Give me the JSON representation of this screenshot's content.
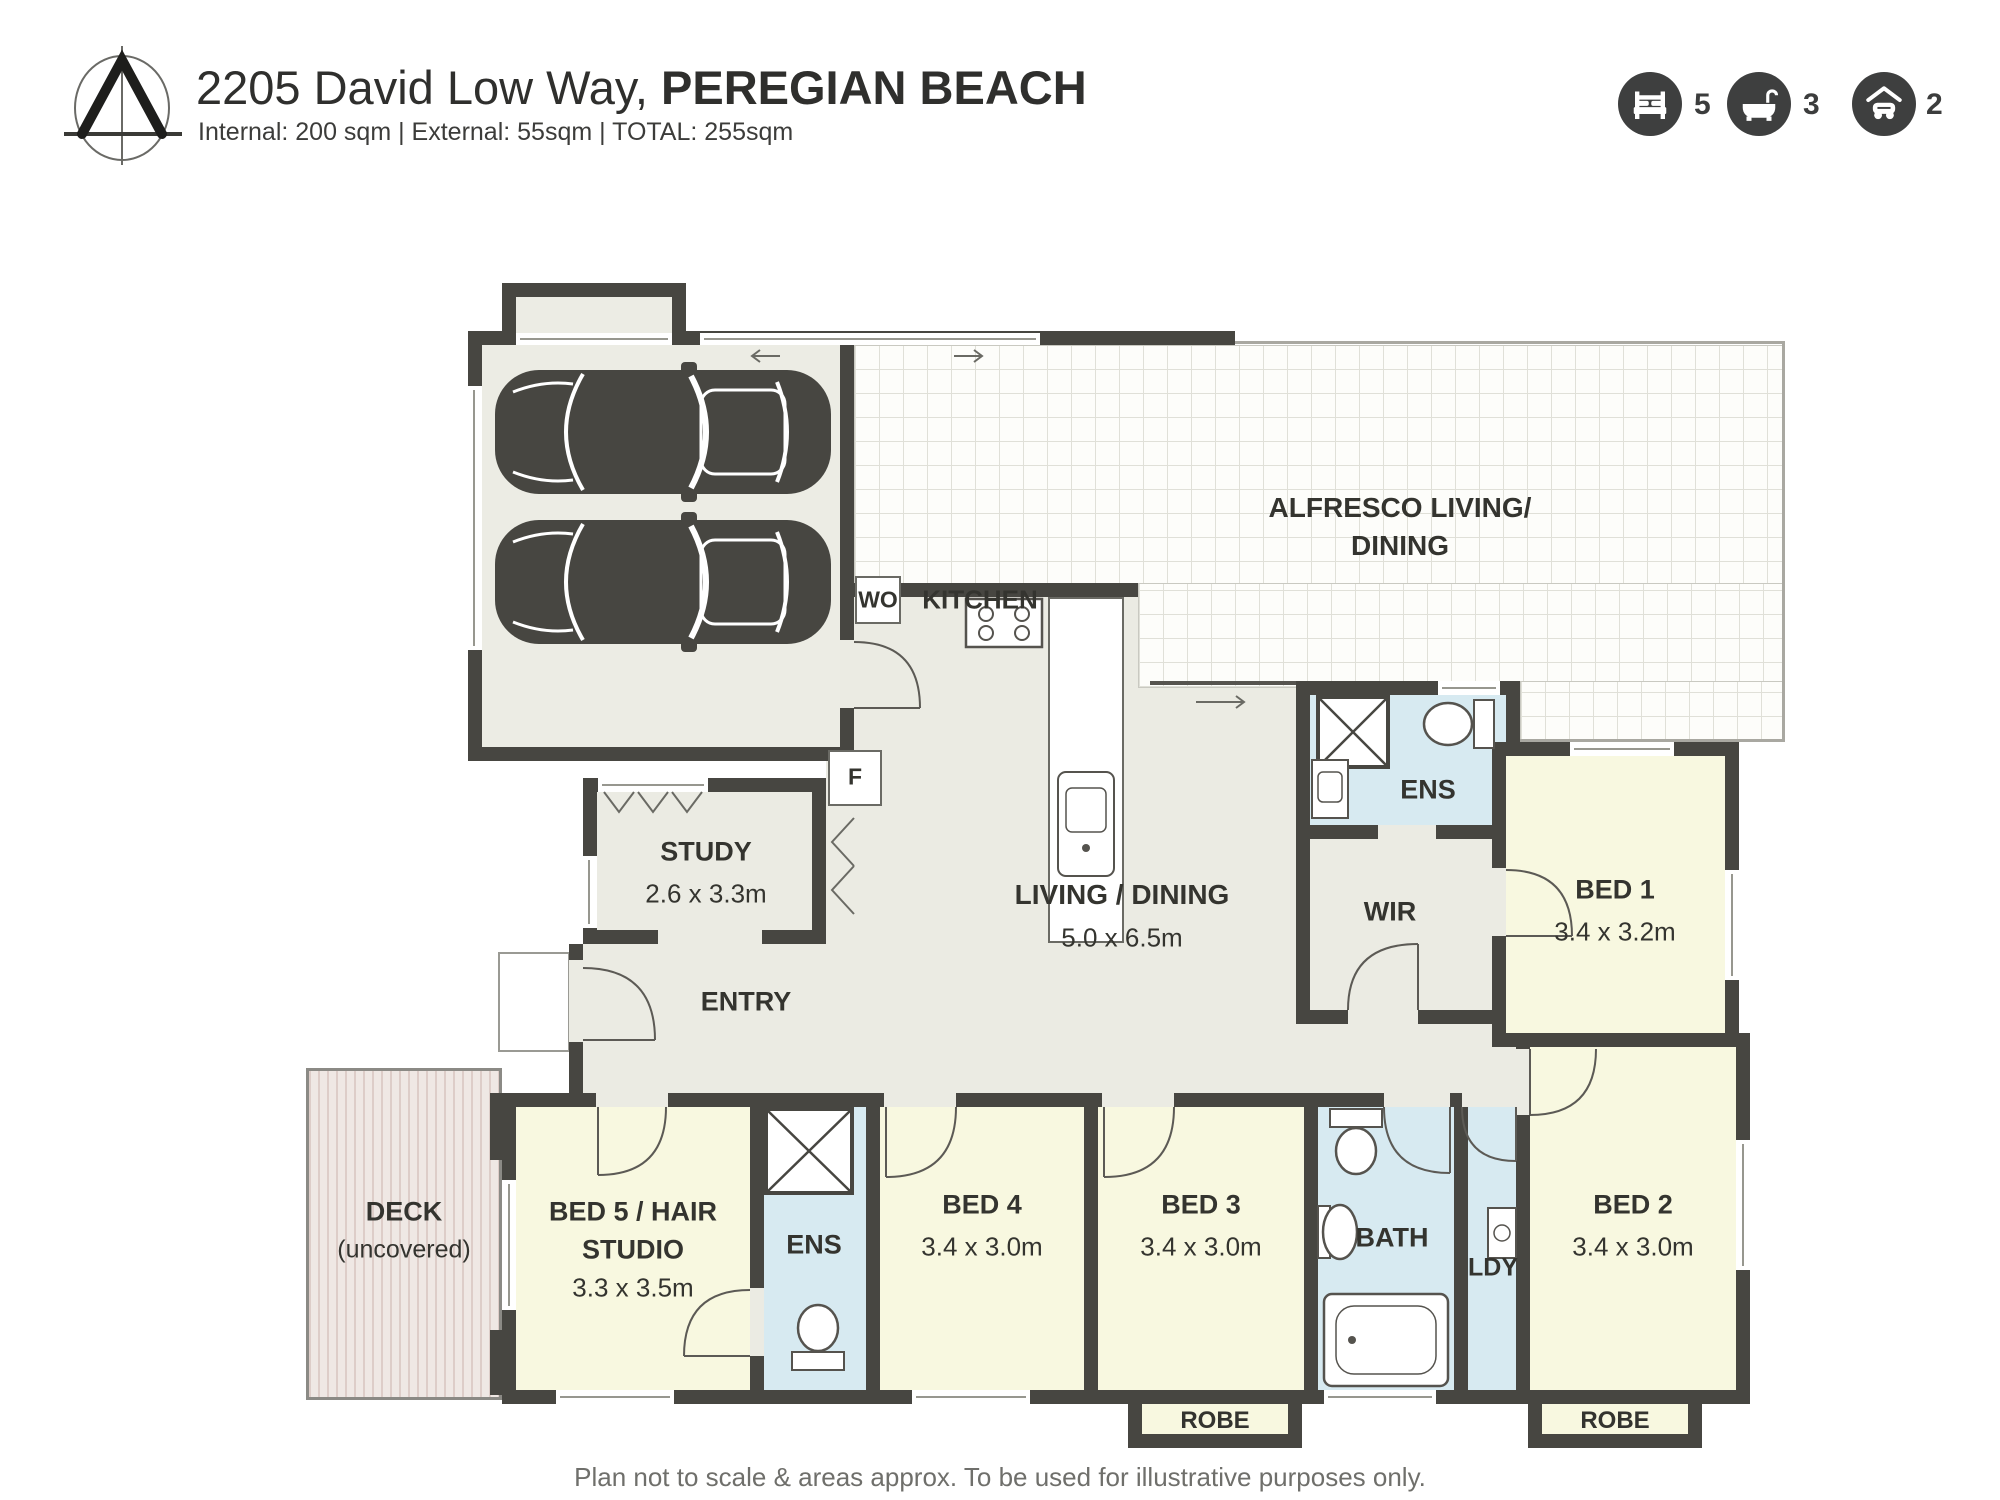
{
  "header": {
    "title_address": "2205 David Low Way, ",
    "title_suburb": "PEREGIAN BEACH",
    "subtitle": "Internal: 200 sqm  |  External: 55sqm  |  TOTAL: 255sqm"
  },
  "badges": {
    "bed": {
      "icon": "bed-icon",
      "value": "5"
    },
    "bath": {
      "icon": "bath-icon",
      "value": "3"
    },
    "car": {
      "icon": "car-icon",
      "value": "2"
    }
  },
  "rooms": {
    "alfresco": {
      "line1": "ALFRESCO LIVING/",
      "line2": "DINING"
    },
    "kitchen": {
      "label": "KITCHEN",
      "wo": "WO",
      "fridge": "F"
    },
    "living": {
      "label": "LIVING / DINING",
      "dims": "5.0 x 6.5m"
    },
    "study": {
      "label": "STUDY",
      "dims": "2.6 x 3.3m"
    },
    "entry": {
      "label": "ENTRY"
    },
    "ens_master": {
      "label": "ENS"
    },
    "wir": {
      "label": "WIR"
    },
    "bed1": {
      "label": "BED 1",
      "dims": "3.4 x 3.2m"
    },
    "deck": {
      "line1": "DECK",
      "line2": "(uncovered)"
    },
    "bed5": {
      "line1": "BED 5 / HAIR",
      "line2": "STUDIO",
      "dims": "3.3 x 3.5m"
    },
    "ens_bed5": {
      "label": "ENS"
    },
    "bed4": {
      "label": "BED 4",
      "dims": "3.4 x 3.0m"
    },
    "bed3": {
      "label": "BED 3",
      "dims": "3.4 x 3.0m"
    },
    "bath": {
      "label": "BATH"
    },
    "ldy": {
      "label": "LDY"
    },
    "bed2": {
      "label": "BED 2",
      "dims": "3.4 x 3.0m"
    },
    "robe_bed3": {
      "label": "ROBE"
    },
    "robe_bed2": {
      "label": "ROBE"
    }
  },
  "footer": {
    "disclaimer": "Plan not to scale & areas approx. To be used for illustrative purposes only."
  },
  "colors": {
    "wall": "#474641",
    "floor_main": "#ebebe3",
    "floor_bedroom": "#f8f8e0",
    "floor_wet": "#d7eaf1",
    "floor_deck": "#efe8e4",
    "badge_background": "#3e3f3f",
    "text": "#34342f"
  }
}
